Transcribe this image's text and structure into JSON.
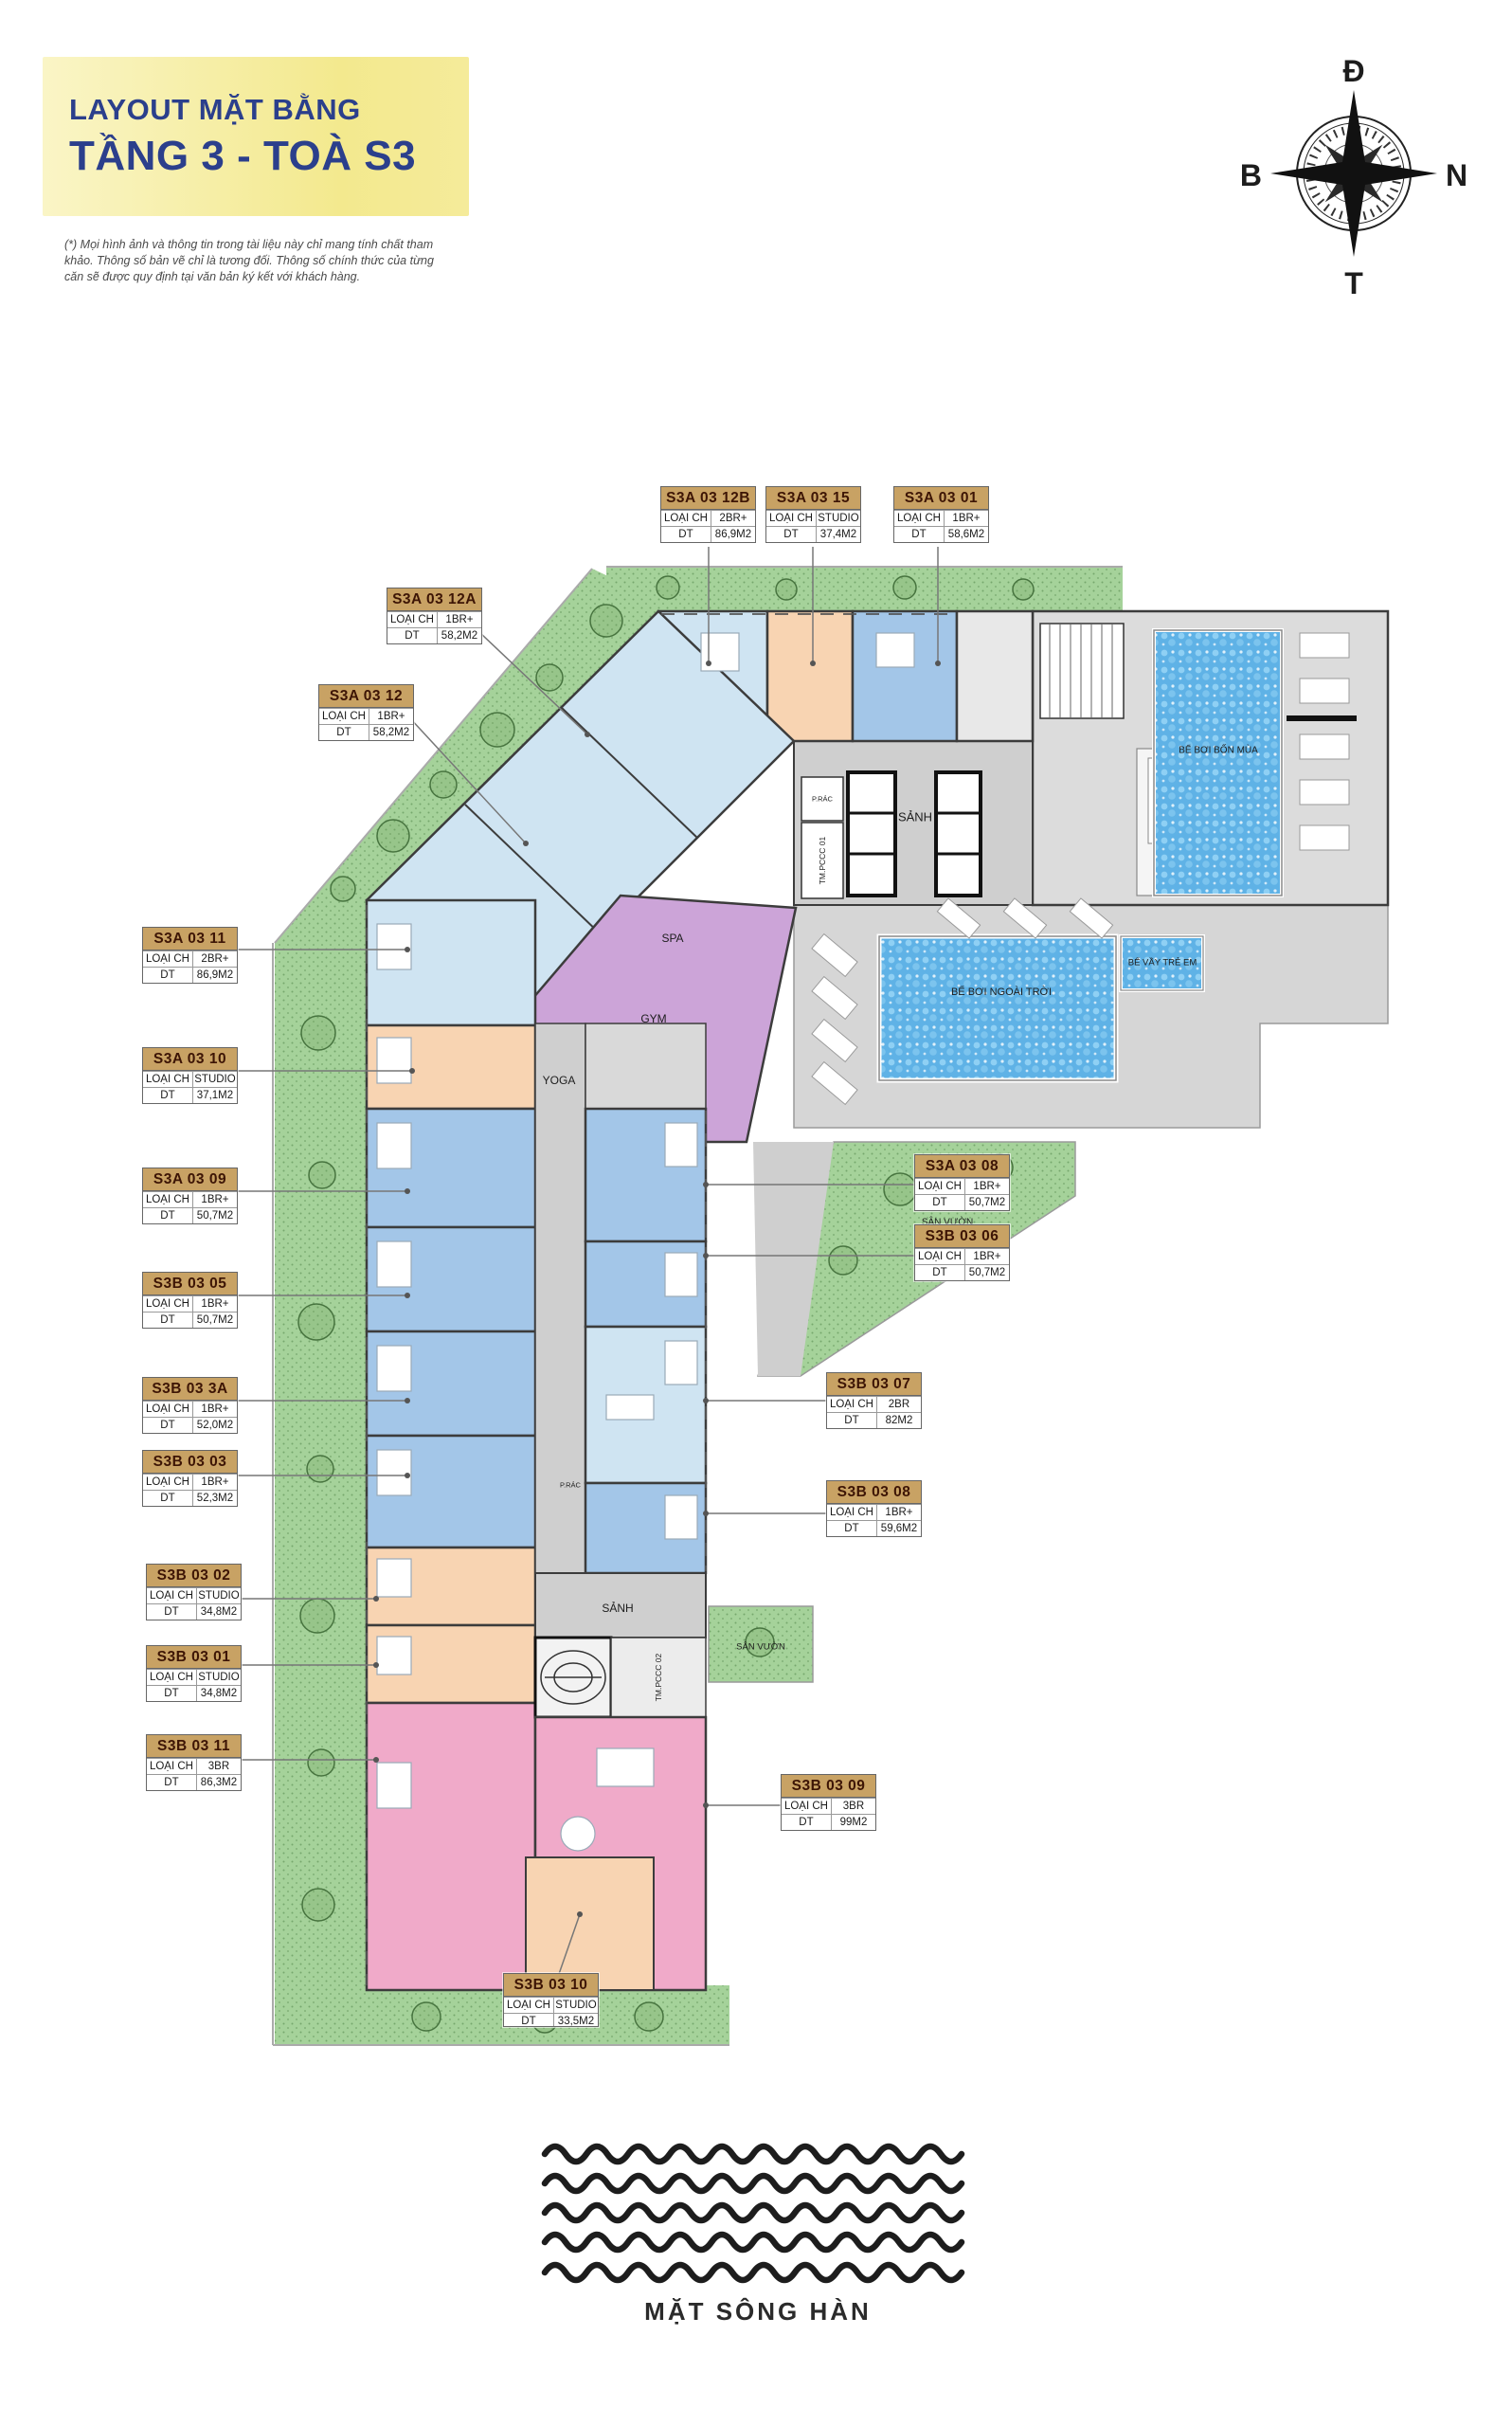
{
  "header": {
    "title_line1": "LAYOUT MẶT BẰNG",
    "title_line2": "TẦNG 3 - TOÀ S3",
    "disclaimer": "(*) Mọi hình ảnh và thông tin trong tài liệu này chỉ mang tính chất tham khảo. Thông số bản vẽ chỉ là tương đối. Thông số chính thức của từng căn sẽ được quy định tại văn bản ký kết với khách hàng."
  },
  "compass": {
    "top": "Đ",
    "left": "B",
    "right": "N",
    "bottom": "T"
  },
  "labels": {
    "loai_ch": "LOẠI CH",
    "dt": "DT"
  },
  "units": [
    {
      "code": "S3A 03 12B",
      "type": "2BR+",
      "area": "86,9M2"
    },
    {
      "code": "S3A 03 15",
      "type": "STUDIO",
      "area": "37,4M2"
    },
    {
      "code": "S3A 03 01",
      "type": "1BR+",
      "area": "58,6M2"
    },
    {
      "code": "S3A 03 12A",
      "type": "1BR+",
      "area": "58,2M2"
    },
    {
      "code": "S3A 03 12",
      "type": "1BR+",
      "area": "58,2M2"
    },
    {
      "code": "S3A 03 11",
      "type": "2BR+",
      "area": "86,9M2"
    },
    {
      "code": "S3A 03 10",
      "type": "STUDIO",
      "area": "37,1M2"
    },
    {
      "code": "S3A 03 09",
      "type": "1BR+",
      "area": "50,7M2"
    },
    {
      "code": "S3B 03 05",
      "type": "1BR+",
      "area": "50,7M2"
    },
    {
      "code": "S3B 03 3A",
      "type": "1BR+",
      "area": "52,0M2"
    },
    {
      "code": "S3B 03 03",
      "type": "1BR+",
      "area": "52,3M2"
    },
    {
      "code": "S3B 03 02",
      "type": "STUDIO",
      "area": "34,8M2"
    },
    {
      "code": "S3B 03 01",
      "type": "STUDIO",
      "area": "34,8M2"
    },
    {
      "code": "S3B 03 11",
      "type": "3BR",
      "area": "86,3M2"
    },
    {
      "code": "S3A 03 08",
      "type": "1BR+",
      "area": "50,7M2"
    },
    {
      "code": "S3B 03 06",
      "type": "1BR+",
      "area": "50,7M2"
    },
    {
      "code": "S3B 03 07",
      "type": "2BR",
      "area": "82M2"
    },
    {
      "code": "S3B 03 08",
      "type": "1BR+",
      "area": "59,6M2"
    },
    {
      "code": "S3B 03 09",
      "type": "3BR",
      "area": "99M2"
    },
    {
      "code": "S3B 03 10",
      "type": "STUDIO",
      "area": "33,5M2"
    }
  ],
  "plan": {
    "lobby_top": "SẢNH",
    "lobby_bottom": "SẢNH",
    "fire_tech_1": "TM.PCCC 01",
    "fire_tech_2": "TM.PCCC 02",
    "trash_1": "P.RÁC",
    "trash_2": "P.RÁC",
    "spa": "SPA",
    "gym": "GYM",
    "yoga": "YOGA",
    "pool_indoor": "BỂ BƠI BỐN MÙA",
    "pool_outdoor": "BỂ BƠI NGOÀI TRỜI",
    "pool_kids": "BỂ VẦY TRẺ EM",
    "garden_1": "SÂN VƯỜN",
    "garden_2": "SÂN VƯỜN"
  },
  "footer": {
    "river_label": "MẶT SÔNG HÀN"
  },
  "colors": {
    "title_navy": "#2b3f8c",
    "title_box_yellow": "#f3e98e",
    "label_header_tan": "#c8a264",
    "label_code_text": "#3d1505",
    "unit_2br_lightblue": "#cfe4f2",
    "unit_1br_blue": "#a3c6e8",
    "unit_studio_peach": "#f8d4b2",
    "unit_3br_pink": "#f0aac9",
    "amenity_purple": "#cca4d8",
    "landscape_green": "#a5d29a",
    "pool_blue": "#5fb2e6",
    "corridor_gray": "#cfcfcf"
  }
}
